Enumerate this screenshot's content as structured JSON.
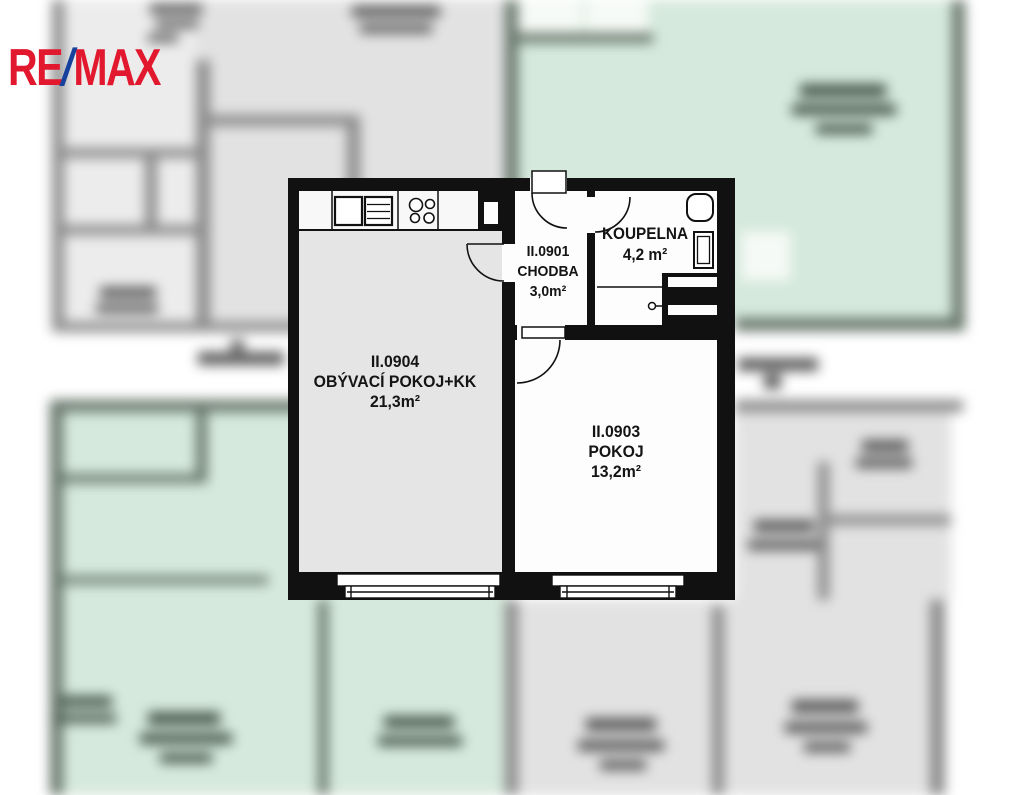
{
  "brand": {
    "logo_re": "RE",
    "logo_slash": "/",
    "logo_max": "MAX"
  },
  "floorplan": {
    "rooms": {
      "living": {
        "id": "II.0904",
        "name": "OBÝVACÍ POKOJ+KK",
        "area": "21,3m²"
      },
      "hallway": {
        "id": "II.0901",
        "name": "CHODBA",
        "area": "3,0m²"
      },
      "bathroom": {
        "name": "KOUPELNA",
        "area": "4,2 m²"
      },
      "bedroom": {
        "id": "II.0903",
        "name": "POKOJ",
        "area": "13,2m²"
      }
    }
  },
  "palette": {
    "logo_red": "#e2182e",
    "logo_blue": "#16419c",
    "wall_black": "#111111",
    "living_floor": "#e5e5e5",
    "room_white": "#fdfdfd",
    "bg_gray_room": "#e2e2e2",
    "bg_gray_room_light": "#ececec",
    "bg_gray_wall": "#8c8c8c",
    "bg_green_room": "#d6e9dd",
    "bg_green_wall": "#68776c",
    "bg_white_room": "#f6faf7",
    "bg_text_green": "#47584c",
    "bg_text_gray": "#5c5c5c",
    "band_white": "#ffffff"
  }
}
